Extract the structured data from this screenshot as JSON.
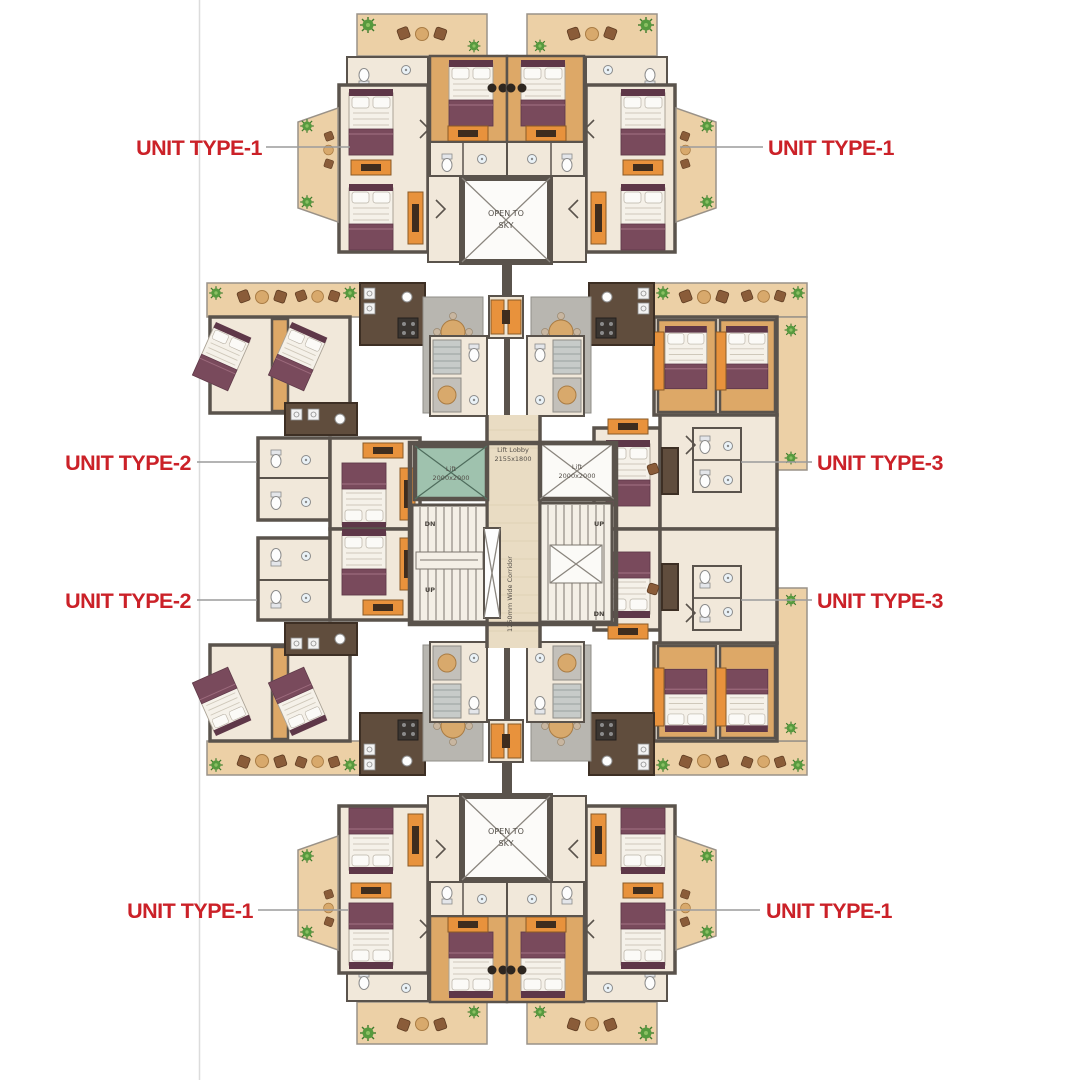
{
  "page": {
    "background": "#ffffff",
    "left_margin_line_color": "#dcdcdc"
  },
  "plan": {
    "unit_labels": [
      {
        "position": "top-left",
        "text": "UNIT TYPE-1"
      },
      {
        "position": "top-right",
        "text": "UNIT TYPE-1"
      },
      {
        "position": "middle-upper-left",
        "text": "UNIT TYPE-2"
      },
      {
        "position": "middle-upper-right",
        "text": "UNIT TYPE-3"
      },
      {
        "position": "middle-lower-left",
        "text": "UNIT TYPE-2"
      },
      {
        "position": "middle-lower-right",
        "text": "UNIT TYPE-3"
      },
      {
        "position": "bottom-left",
        "text": "UNIT TYPE-1"
      },
      {
        "position": "bottom-right",
        "text": "UNIT TYPE-1"
      }
    ],
    "annotations": {
      "open_to_sky_line1": "OPEN TO",
      "open_to_sky_line2": "SKY",
      "lift_lobby_line1": "Lift Lobby",
      "lift_lobby_line2": "2155x1800",
      "lift_line1": "Lift",
      "lift_line2": "2000x2000",
      "corridor": "1250mm Wide Corridor",
      "stair_up": "UP",
      "stair_dn": "DN"
    },
    "colors": {
      "label_red": "#cb2128",
      "leader_gray": "#9b9b9b",
      "wall": "#5a534c",
      "floor_cream": "#f1e8da",
      "wood": "#dda867",
      "balcony_tan": "#ecd0a6",
      "furniture_orange": "#e8923c",
      "bed_maroon": "#794a5c",
      "lift_teal": "#9fc2ae",
      "kitchen_brown": "#604d3d",
      "rug_gray": "#b8b6b0",
      "plant_green": "#5f9e45"
    }
  }
}
